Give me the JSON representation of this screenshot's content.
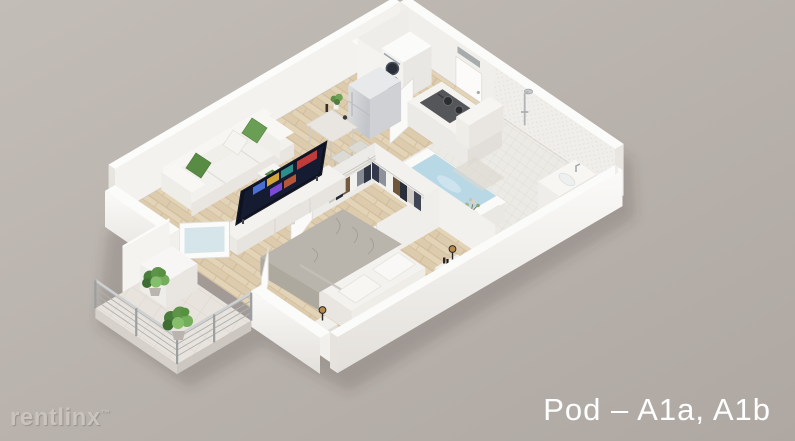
{
  "scene": {
    "caption": {
      "text": "Pod – A1a, A1b",
      "color": "#ffffff"
    },
    "watermark": {
      "text": "rentlinx",
      "mark": "™",
      "color": "#cac4be"
    },
    "background": {
      "top_left": "#c3bdb7",
      "bottom_right": "#afa8a2"
    }
  },
  "floorplan": {
    "style": "3d-isometric-render",
    "wall_color": "#f4f3f0",
    "wood_floor_color": "#e3d4b8",
    "bath_tile_color": "#eceae5",
    "accent_green": "#5f9049",
    "tub_water_color": "#b9d8e6",
    "rooms": [
      {
        "name": "kitchen-dining",
        "items": [
          "refrigerator",
          "stacked-washer-dryer",
          "cooktop-counter",
          "dining-table",
          "stools",
          "table-plant"
        ]
      },
      {
        "name": "living-room",
        "items": [
          "sofa",
          "green-pillows",
          "coffee-cube-table",
          "tv",
          "media-console"
        ]
      },
      {
        "name": "bathroom",
        "items": [
          "walk-in-shower",
          "bathtub",
          "vanity-sink",
          "toilet",
          "flower-decor"
        ]
      },
      {
        "name": "walk-in-closet",
        "items": [
          "hanging-clothes",
          "wire-rails",
          "closet-doors",
          "floor-plant"
        ]
      },
      {
        "name": "bedroom",
        "items": [
          "bed",
          "gray-duvet",
          "white-pillows",
          "nightstands",
          "amber-lamps"
        ]
      },
      {
        "name": "balcony",
        "items": [
          "cable-railing",
          "potted-plants",
          "privacy-wall",
          "storage-cabinet",
          "french-doors"
        ]
      }
    ]
  }
}
